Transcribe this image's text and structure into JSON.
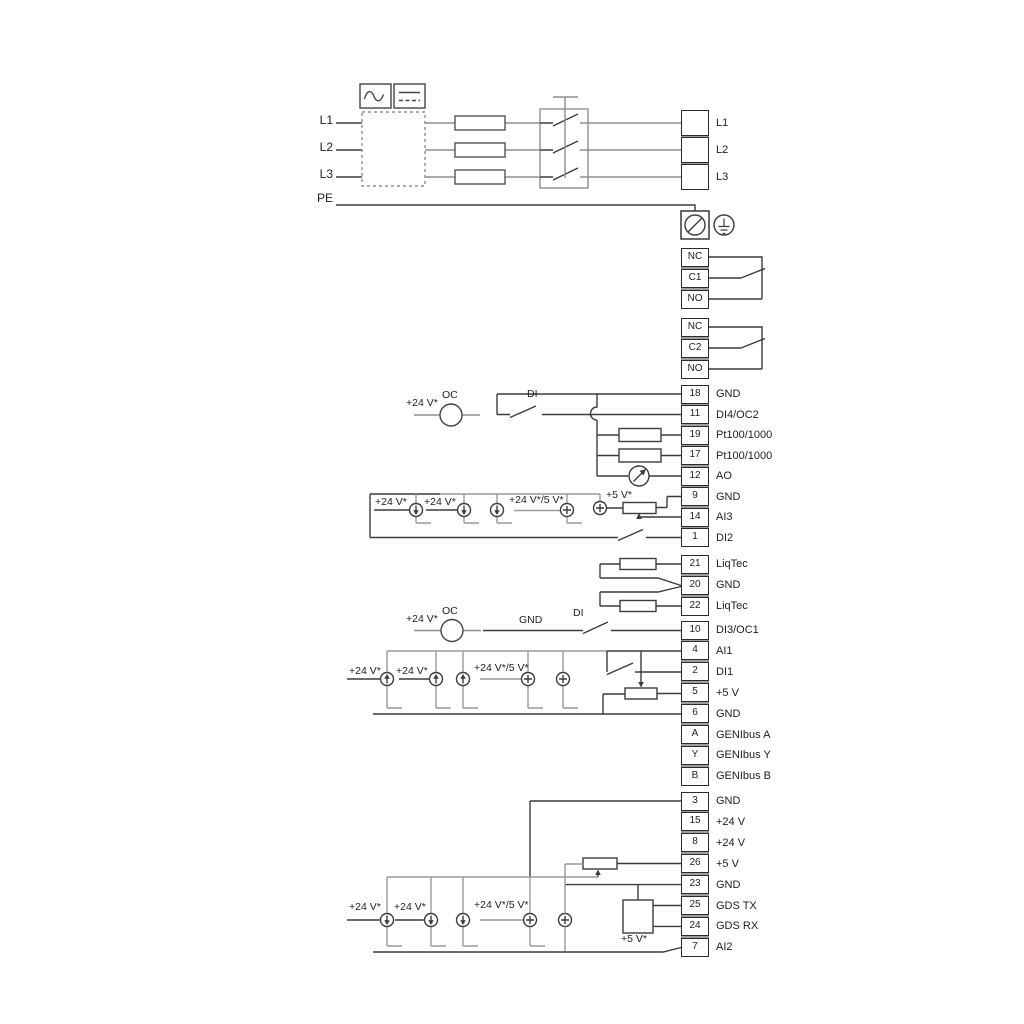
{
  "diagram": "wiring-diagram",
  "colors": {
    "line": "#3c3c3c",
    "gray_line": "#9a9a9a",
    "terminal_border": "#2b2b2b",
    "terminal_gap": "#9e9e9e",
    "background": "#ffffff"
  },
  "power_in": {
    "labels": [
      "L1",
      "L2",
      "L3",
      "PE"
    ]
  },
  "terminal_groups": [
    {
      "id": "power-out",
      "cells": [
        {
          "pin": "",
          "label": "L1"
        },
        {
          "pin": "",
          "label": "L2"
        },
        {
          "pin": "",
          "label": "L3"
        }
      ]
    },
    {
      "id": "relay-1",
      "cells": [
        {
          "pin": "NC",
          "label": ""
        },
        {
          "pin": "C1",
          "label": ""
        },
        {
          "pin": "NO",
          "label": ""
        }
      ]
    },
    {
      "id": "relay-2",
      "cells": [
        {
          "pin": "NC",
          "label": ""
        },
        {
          "pin": "C2",
          "label": ""
        },
        {
          "pin": "NO",
          "label": ""
        }
      ]
    },
    {
      "id": "io-top",
      "cells": [
        {
          "pin": "18",
          "label": "GND"
        },
        {
          "pin": "11",
          "label": "DI4/OC2"
        },
        {
          "pin": "19",
          "label": "Pt100/1000"
        },
        {
          "pin": "17",
          "label": "Pt100/1000"
        },
        {
          "pin": "12",
          "label": "AO"
        },
        {
          "pin": "9",
          "label": "GND"
        },
        {
          "pin": "14",
          "label": "AI3"
        },
        {
          "pin": "1",
          "label": "DI2"
        }
      ]
    },
    {
      "id": "liqtec",
      "cells": [
        {
          "pin": "21",
          "label": "LiqTec"
        },
        {
          "pin": "20",
          "label": "GND"
        },
        {
          "pin": "22",
          "label": "LiqTec"
        }
      ]
    },
    {
      "id": "io-mid",
      "cells": [
        {
          "pin": "10",
          "label": "DI3/OC1"
        },
        {
          "pin": "4",
          "label": "AI1"
        },
        {
          "pin": "2",
          "label": "DI1"
        },
        {
          "pin": "5",
          "label": "+5 V"
        },
        {
          "pin": "6",
          "label": "GND"
        },
        {
          "pin": "A",
          "label": "GENIbus A"
        },
        {
          "pin": "Y",
          "label": "GENIbus Y"
        },
        {
          "pin": "B",
          "label": "GENIbus B"
        }
      ]
    },
    {
      "id": "io-bottom",
      "cells": [
        {
          "pin": "3",
          "label": "GND"
        },
        {
          "pin": "15",
          "label": "+24 V"
        },
        {
          "pin": "8",
          "label": "+24 V"
        },
        {
          "pin": "26",
          "label": "+5 V"
        },
        {
          "pin": "23",
          "label": "GND"
        },
        {
          "pin": "25",
          "label": "GDS TX"
        },
        {
          "pin": "24",
          "label": "GDS RX"
        },
        {
          "pin": "7",
          "label": "AI2"
        }
      ]
    }
  ],
  "annotations": {
    "r1_v24": "+24 V*",
    "r1_oc": "OC",
    "r1_di": "DI",
    "r2_v24a": "+24 V*",
    "r2_v24b": "+24 V*",
    "r2_v245": "+24 V*/5 V*",
    "r2_v5": "+5 V*",
    "r3_v24": "+24 V*",
    "r3_oc": "OC",
    "r3_gnd": "GND",
    "r3_di": "DI",
    "r4_v24a": "+24 V*",
    "r4_v24b": "+24 V*",
    "r4_v245": "+24 V*/5 V*",
    "r5_v24a": "+24 V*",
    "r5_v24b": "+24 V*",
    "r5_v245": "+24 V*/5 V*",
    "r5_v5": "+5 V*"
  }
}
